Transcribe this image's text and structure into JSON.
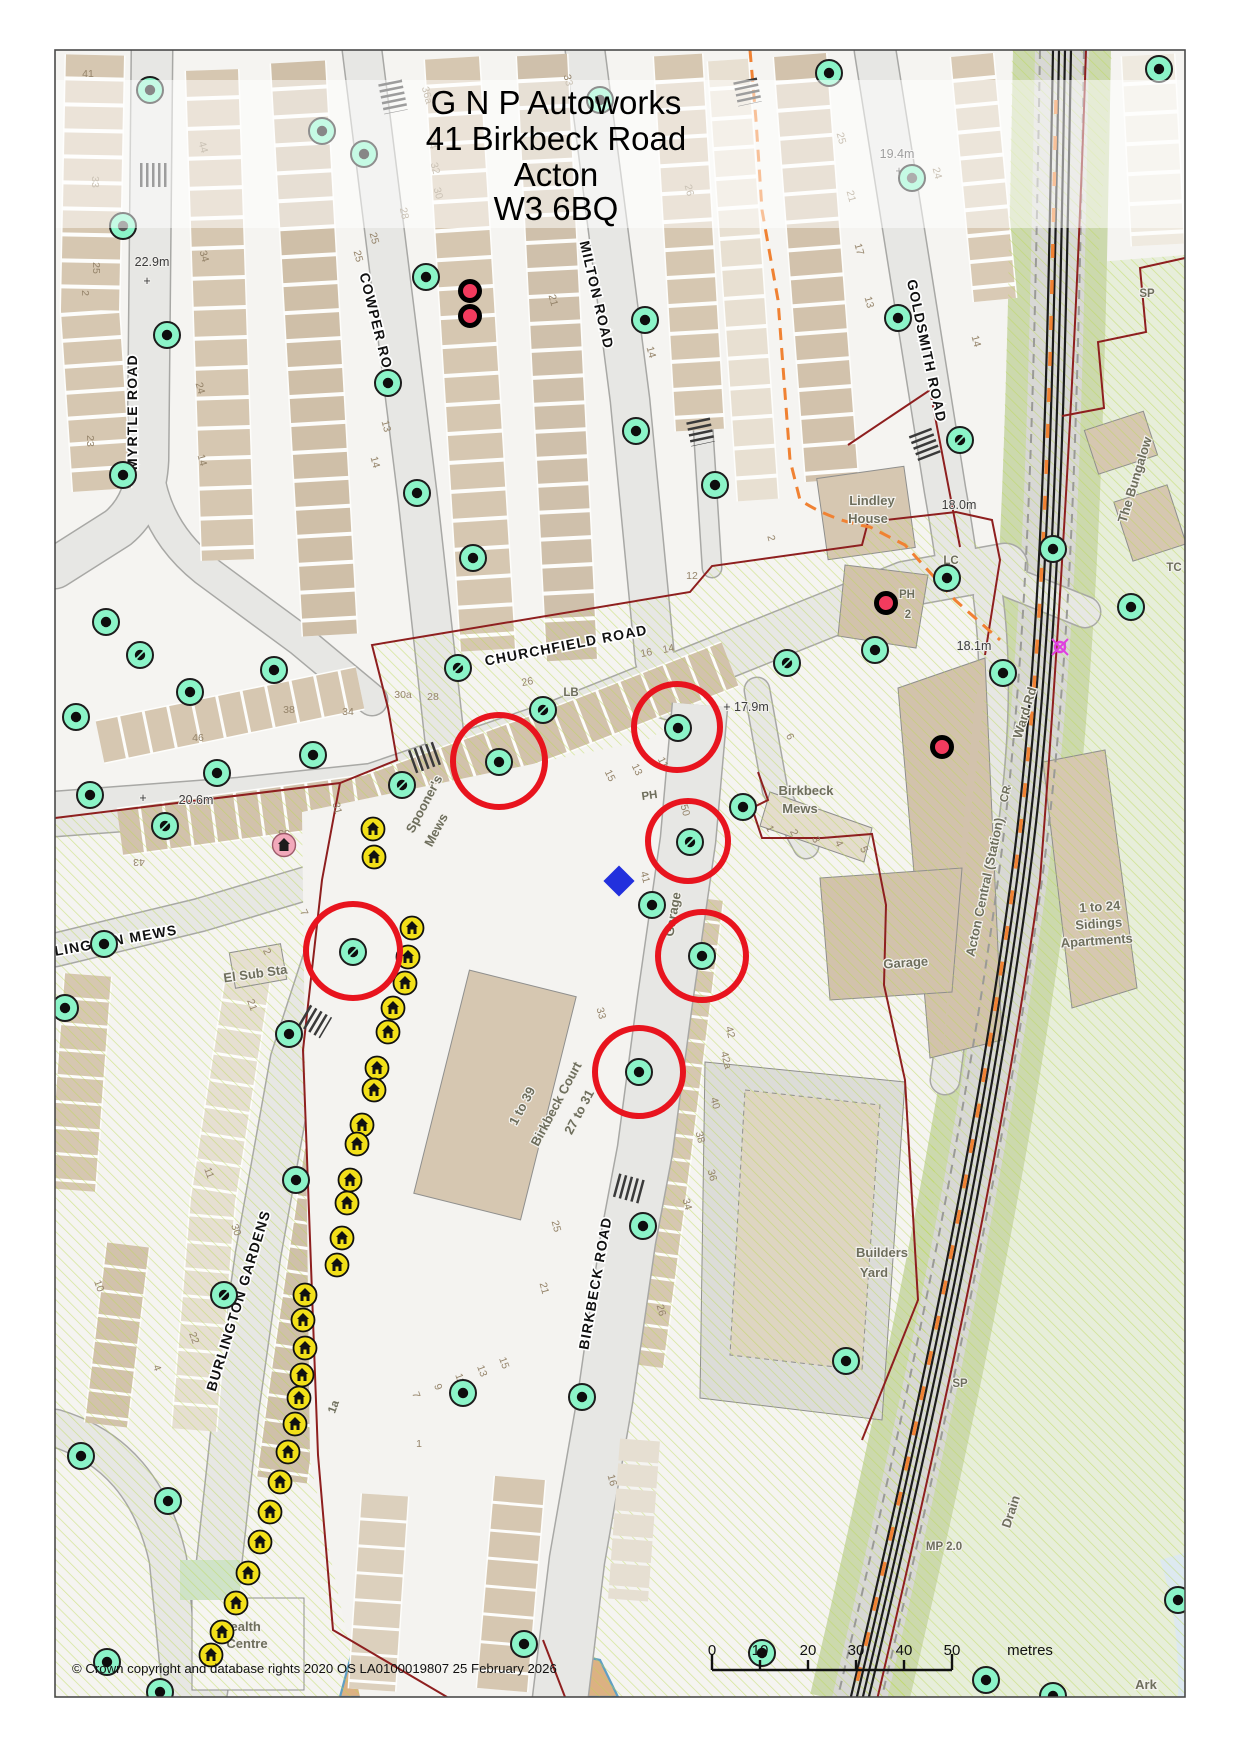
{
  "map": {
    "title_lines": [
      "G N P Autoworks",
      "41 Birkbeck Road",
      "Acton",
      "W3 6BQ"
    ],
    "copyright": "© Crown copyright and database rights 2020 OS LA0100019807  25 February 2026",
    "scale_bar": {
      "tick_labels": [
        "0",
        "10",
        "20",
        "30",
        "40",
        "50"
      ],
      "unit_label": "metres"
    },
    "palette": {
      "highlight_red": "#e8141e",
      "marker_green": "#8bf4c8",
      "marker_yellow": "#f2e019",
      "marker_pink": "#f2a9bb",
      "dot_crimson": "#f23b5e",
      "diamond_blue": "#2230dd",
      "route_orange": "#f08233",
      "boundary_red": "#8e1f1f",
      "building_tan": "#d6c7b1",
      "hatch_green": "#b9d84f"
    },
    "street_labels": [
      [
        "MYRTLE ROAD",
        137,
        412,
        -90
      ],
      [
        "COWPER ROAD",
        374,
        333,
        76
      ],
      [
        "MILTON ROAD",
        592,
        296,
        77
      ],
      [
        "GOLDSMITH ROAD",
        922,
        352,
        78
      ],
      [
        "CHURCHFIELD ROAD",
        567,
        650,
        -11
      ],
      [
        "BIRKBECK ROAD",
        600,
        1284,
        -80
      ],
      [
        "BURLINGTON GARDENS",
        243,
        1302,
        -73
      ],
      [
        "BURLINGTON MEWS",
        100,
        948,
        -10
      ]
    ],
    "area_labels": [
      [
        "Acton Central (Station)",
        989,
        888,
        -78
      ],
      [
        "Ward Rd",
        1029,
        714,
        -73
      ],
      [
        "Birkbeck",
        806,
        795,
        0
      ],
      [
        "Mews",
        800,
        813,
        0
      ],
      [
        "Spooner's",
        428,
        806,
        -62
      ],
      [
        "Mews",
        440,
        832,
        -62
      ],
      [
        "Lindley",
        872,
        505,
        0
      ],
      [
        "House",
        868,
        523,
        0
      ],
      [
        "El Sub Sta",
        256,
        978,
        -8
      ],
      [
        "Garage",
        906,
        967,
        -4
      ],
      [
        "Garage",
        677,
        915,
        -80
      ],
      [
        "1 to 39",
        526,
        1108,
        -62
      ],
      [
        "Birkbeck Court",
        560,
        1106,
        -62
      ],
      [
        "27 to 31",
        583,
        1114,
        -62
      ],
      [
        "Builders",
        882,
        1257,
        0
      ],
      [
        "Yard",
        874,
        1277,
        0
      ],
      [
        "1 to 24",
        1100,
        911,
        -4
      ],
      [
        "Sidings",
        1099,
        928,
        -4
      ],
      [
        "Apartments",
        1097,
        945,
        -4
      ],
      [
        "The Bungalow",
        1139,
        481,
        -73
      ],
      [
        "Health",
        241,
        1631,
        0
      ],
      [
        "Centre",
        247,
        1648,
        0
      ],
      [
        "Ark",
        1146,
        1689,
        0
      ],
      [
        "Drain",
        1015,
        1513,
        -72
      ]
    ],
    "small_labels": [
      [
        "LB",
        571,
        696,
        0
      ],
      [
        "PH",
        650,
        799,
        -8
      ],
      [
        "PH",
        907,
        598,
        0
      ],
      [
        "2",
        908,
        618,
        0
      ],
      [
        "SP",
        1147,
        297,
        0
      ],
      [
        "SP",
        960,
        1387,
        0
      ],
      [
        "MP 2.0",
        944,
        1550,
        0
      ],
      [
        "LC",
        951,
        564,
        0
      ],
      [
        "TC",
        1174,
        571,
        0
      ],
      [
        "CR",
        1009,
        795,
        -75
      ],
      [
        "1a",
        337,
        1408,
        -70
      ]
    ],
    "spot_heights": [
      [
        "22.9m",
        152,
        266,
        0
      ],
      [
        "+",
        147,
        285,
        0
      ],
      [
        "19.4m",
        897,
        158,
        0
      ],
      [
        "+",
        899,
        175,
        0
      ],
      [
        "18.0m",
        959,
        509,
        0
      ],
      [
        "18.1m",
        974,
        650,
        0
      ],
      [
        "+ 17.9m",
        746,
        711,
        0
      ],
      [
        "20.6m",
        196,
        804,
        0
      ],
      [
        "+",
        143,
        802,
        0
      ]
    ],
    "house_numbers": [
      [
        "41",
        88,
        77,
        0
      ],
      [
        "33",
        92,
        182,
        90
      ],
      [
        "25",
        93,
        268,
        90
      ],
      [
        "2",
        82,
        293,
        90
      ],
      [
        "23",
        87,
        441,
        90
      ],
      [
        "44",
        200,
        148,
        75
      ],
      [
        "34",
        201,
        257,
        75
      ],
      [
        "24",
        197,
        389,
        75
      ],
      [
        "14",
        199,
        461,
        75
      ],
      [
        "36a",
        424,
        96,
        75
      ],
      [
        "34",
        429,
        144,
        75
      ],
      [
        "32",
        432,
        169,
        75
      ],
      [
        "30",
        435,
        194,
        75
      ],
      [
        "28",
        401,
        214,
        78
      ],
      [
        "25",
        371,
        239,
        75
      ],
      [
        "25",
        355,
        257,
        75
      ],
      [
        "13",
        383,
        427,
        75
      ],
      [
        "14",
        372,
        463,
        75
      ],
      [
        "33",
        565,
        81,
        75
      ],
      [
        "26",
        686,
        191,
        75
      ],
      [
        "21",
        550,
        301,
        75
      ],
      [
        "14",
        648,
        353,
        75
      ],
      [
        "12",
        692,
        579,
        0
      ],
      [
        "16",
        647,
        656,
        -11
      ],
      [
        "14",
        669,
        652,
        -11
      ],
      [
        "25",
        838,
        139,
        75
      ],
      [
        "21",
        848,
        197,
        75
      ],
      [
        "17",
        856,
        250,
        75
      ],
      [
        "13",
        866,
        303,
        75
      ],
      [
        "24",
        934,
        174,
        75
      ],
      [
        "14",
        973,
        342,
        75
      ],
      [
        "2",
        768,
        539,
        75
      ],
      [
        "30a",
        403,
        698,
        0
      ],
      [
        "28",
        433,
        700,
        0
      ],
      [
        "34",
        348,
        715,
        0
      ],
      [
        "38",
        289,
        713,
        0
      ],
      [
        "46",
        198,
        741,
        0
      ],
      [
        "26",
        528,
        685,
        -11
      ],
      [
        "15",
        607,
        777,
        64
      ],
      [
        "13",
        634,
        771,
        64
      ],
      [
        "11",
        660,
        764,
        64
      ],
      [
        "6",
        787,
        738,
        64
      ],
      [
        "31",
        334,
        809,
        75
      ],
      [
        "43",
        139,
        859,
        180
      ],
      [
        "33",
        284,
        830,
        180
      ],
      [
        "1",
        767,
        830,
        64
      ],
      [
        "2",
        791,
        834,
        64
      ],
      [
        "3",
        813,
        841,
        64
      ],
      [
        "4",
        836,
        845,
        64
      ],
      [
        "5",
        861,
        851,
        64
      ],
      [
        "50",
        682,
        811,
        75
      ],
      [
        "41",
        642,
        878,
        75
      ],
      [
        "33",
        598,
        1014,
        75
      ],
      [
        "25",
        553,
        1227,
        75
      ],
      [
        "21",
        541,
        1289,
        75
      ],
      [
        "15",
        501,
        1364,
        70
      ],
      [
        "13",
        479,
        1372,
        70
      ],
      [
        "11",
        457,
        1380,
        70
      ],
      [
        "9",
        435,
        1388,
        70
      ],
      [
        "7",
        413,
        1396,
        70
      ],
      [
        "1",
        419,
        1447,
        0
      ],
      [
        "42",
        727,
        1033,
        75
      ],
      [
        "42a",
        723,
        1061,
        75
      ],
      [
        "40",
        712,
        1104,
        75
      ],
      [
        "38",
        697,
        1138,
        75
      ],
      [
        "36",
        709,
        1176,
        75
      ],
      [
        "34",
        684,
        1205,
        75
      ],
      [
        "26",
        658,
        1311,
        75
      ],
      [
        "21",
        249,
        1006,
        70
      ],
      [
        "11",
        206,
        1174,
        70
      ],
      [
        "30",
        233,
        1231,
        70
      ],
      [
        "22",
        191,
        1339,
        70
      ],
      [
        "10",
        96,
        1287,
        70
      ],
      [
        "4",
        154,
        1369,
        70
      ],
      [
        "7",
        301,
        914,
        64
      ],
      [
        "2",
        264,
        953,
        64
      ],
      [
        "16",
        609,
        1481,
        75
      ]
    ],
    "markers": {
      "green": [
        [
          150,
          90,
          "b"
        ],
        [
          322,
          131,
          "b"
        ],
        [
          364,
          154,
          "b"
        ],
        [
          600,
          100,
          "b"
        ],
        [
          829,
          73,
          "b"
        ],
        [
          1159,
          69,
          "b"
        ],
        [
          123,
          226,
          "g"
        ],
        [
          167,
          335,
          "b"
        ],
        [
          123,
          475,
          "b"
        ],
        [
          426,
          277,
          "b"
        ],
        [
          388,
          383,
          "b"
        ],
        [
          417,
          493,
          "b"
        ],
        [
          645,
          320,
          "b"
        ],
        [
          636,
          431,
          "b"
        ],
        [
          912,
          178,
          "g"
        ],
        [
          898,
          318,
          "b"
        ],
        [
          960,
          440,
          "s"
        ],
        [
          715,
          485,
          "b"
        ],
        [
          473,
          558,
          "b"
        ],
        [
          106,
          622,
          "b"
        ],
        [
          140,
          655,
          "s"
        ],
        [
          274,
          670,
          "b"
        ],
        [
          190,
          692,
          "b"
        ],
        [
          76,
          717,
          "b"
        ],
        [
          458,
          668,
          "s"
        ],
        [
          543,
          710,
          "s"
        ],
        [
          402,
          785,
          "s"
        ],
        [
          313,
          755,
          "b"
        ],
        [
          217,
          773,
          "b"
        ],
        [
          90,
          795,
          "b"
        ],
        [
          165,
          826,
          "s"
        ],
        [
          499,
          762,
          "b"
        ],
        [
          678,
          728,
          "b"
        ],
        [
          690,
          842,
          "s"
        ],
        [
          743,
          807,
          "b"
        ],
        [
          787,
          663,
          "s"
        ],
        [
          875,
          650,
          "b"
        ],
        [
          947,
          578,
          "b"
        ],
        [
          1003,
          673,
          "b"
        ],
        [
          1053,
          549,
          "b"
        ],
        [
          1131,
          607,
          "b"
        ],
        [
          652,
          905,
          "b"
        ],
        [
          702,
          956,
          "b"
        ],
        [
          639,
          1072,
          "b"
        ],
        [
          643,
          1226,
          "b"
        ],
        [
          353,
          952,
          "s"
        ],
        [
          289,
          1034,
          "b"
        ],
        [
          296,
          1180,
          "b"
        ],
        [
          224,
          1295,
          "s"
        ],
        [
          582,
          1397,
          "b"
        ],
        [
          463,
          1393,
          "b"
        ],
        [
          846,
          1361,
          "b"
        ],
        [
          104,
          944,
          "b"
        ],
        [
          65,
          1008,
          "b"
        ],
        [
          168,
          1501,
          "b"
        ],
        [
          81,
          1456,
          "b"
        ],
        [
          107,
          1662,
          "b"
        ],
        [
          160,
          1692,
          "b"
        ],
        [
          524,
          1644,
          "b"
        ],
        [
          762,
          1653,
          "b"
        ],
        [
          986,
          1680,
          "b"
        ],
        [
          1178,
          1600,
          "b"
        ],
        [
          1053,
          1696,
          "b"
        ]
      ],
      "yellow": [
        [
          373,
          829
        ],
        [
          374,
          857
        ],
        [
          412,
          928
        ],
        [
          408,
          957
        ],
        [
          405,
          983
        ],
        [
          393,
          1008
        ],
        [
          388,
          1032
        ],
        [
          377,
          1068
        ],
        [
          374,
          1090
        ],
        [
          362,
          1125
        ],
        [
          357,
          1144
        ],
        [
          350,
          1180
        ],
        [
          347,
          1203
        ],
        [
          342,
          1238
        ],
        [
          337,
          1265
        ],
        [
          305,
          1295
        ],
        [
          303,
          1320
        ],
        [
          305,
          1348
        ],
        [
          302,
          1375
        ],
        [
          299,
          1398
        ],
        [
          295,
          1424
        ],
        [
          288,
          1452
        ],
        [
          280,
          1482
        ],
        [
          270,
          1512
        ],
        [
          260,
          1542
        ],
        [
          248,
          1573
        ],
        [
          236,
          1603
        ],
        [
          222,
          1632
        ],
        [
          211,
          1655
        ]
      ],
      "pink": [
        [
          284,
          845
        ]
      ],
      "crimson": [
        [
          470,
          291
        ],
        [
          470,
          316
        ],
        [
          886,
          603
        ],
        [
          942,
          747
        ]
      ],
      "blue_diamond": [
        [
          619,
          881
        ]
      ],
      "level_crossing": [
        [
          1060,
          647
        ]
      ]
    },
    "highlight_circles": [
      [
        499,
        761,
        46
      ],
      [
        677,
        727,
        43
      ],
      [
        688,
        841,
        40
      ],
      [
        702,
        956,
        44
      ],
      [
        639,
        1072,
        44
      ],
      [
        353,
        951,
        47
      ]
    ]
  }
}
